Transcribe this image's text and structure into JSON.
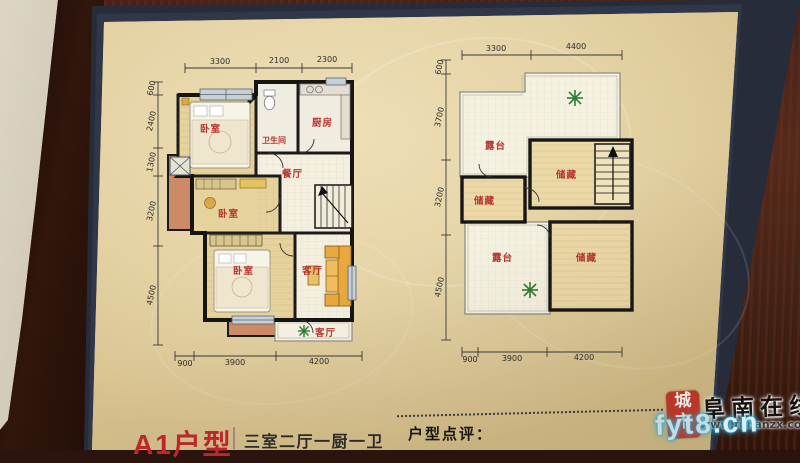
{
  "bottom_bar": {
    "unit_title": "A1户型",
    "unit_spec": "三室二厅一厨一卫",
    "review_label": "户型点评："
  },
  "watermark": {
    "seal_line1": "城",
    "seal_line2": "市",
    "site_name": "阜南在线",
    "site_url": "www.funanzx.com",
    "overlay_text": "fyt8.cn"
  },
  "left_plan": {
    "dims_top": [
      "3300",
      "2100",
      "2300"
    ],
    "dims_left": [
      "600",
      "2400",
      "1300",
      "3200",
      "4500"
    ],
    "dims_bottom": [
      "900",
      "3900",
      "4200"
    ],
    "rooms": {
      "bedroom_top": "卧室",
      "bathroom": "卫生间",
      "kitchen": "厨房",
      "dining": "餐厅",
      "bedroom_mid": "卧室",
      "bedroom_bottom": "卧室",
      "living": "客厅",
      "balcony": "客厅"
    }
  },
  "right_plan": {
    "dims_top": [
      "3300",
      "4400"
    ],
    "dims_left": [
      "600",
      "3700",
      "3200",
      "4500"
    ],
    "dims_bottom": [
      "900",
      "3900",
      "4200"
    ],
    "rooms": {
      "terrace_top": "露台",
      "storage_right": "储藏",
      "storage_left": "储藏",
      "terrace_bottom": "露台",
      "storage_bottom": "储藏"
    }
  },
  "colors": {
    "accent_red": "#c1272d",
    "room_label_red": "#b5342e",
    "page_beige": "#e3d2a6",
    "wall_black": "#1a1a1a",
    "floor_tan": "#e6d29c",
    "balcony_salmon": "#cd8a66",
    "watermark_cyan": "#35b6e9"
  }
}
